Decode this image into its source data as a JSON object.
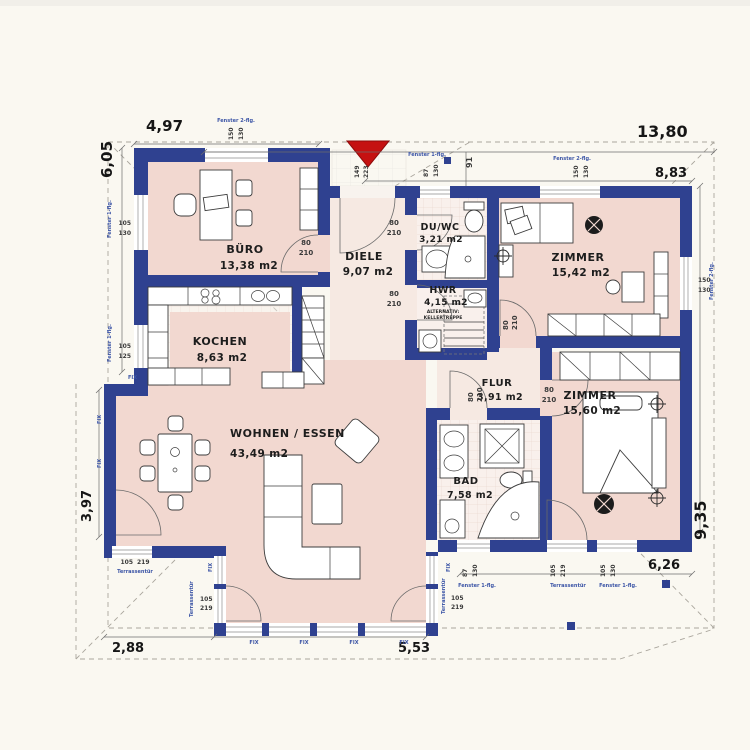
{
  "plan_title": "Erdgeschoss Grundriss",
  "colors": {
    "wall": "#2f4190",
    "room_pink": "#f2d8d0",
    "hall_pale": "#f6e9e2",
    "tile": "#f9f0ec",
    "background": "#faf8f1",
    "entrance_red": "#c51111",
    "label_blue": "#3c55a6"
  },
  "rooms": [
    {
      "id": "buero",
      "name": "BÜRO",
      "area": "13,38 m2"
    },
    {
      "id": "kochen",
      "name": "KOCHEN",
      "area": "8,63 m2"
    },
    {
      "id": "wohnen",
      "name": "WOHNEN / ESSEN",
      "area": "43,49 m2"
    },
    {
      "id": "diele",
      "name": "DIELE",
      "area": "9,07 m2"
    },
    {
      "id": "duwc",
      "name": "DU/WC",
      "area": "3,21 m2"
    },
    {
      "id": "hwr",
      "name": "HWR",
      "area": "4,15 m2",
      "note1": "ALTERNATIV:",
      "note2": "KELLERTREPPE"
    },
    {
      "id": "zimmer1",
      "name": "ZIMMER",
      "area": "15,42 m2"
    },
    {
      "id": "flur",
      "name": "FLUR",
      "area": "3,91 m2"
    },
    {
      "id": "bad",
      "name": "BAD",
      "area": "7,58 m2"
    },
    {
      "id": "zimmer2",
      "name": "ZIMMER",
      "area": "15,60 m2"
    }
  ],
  "dimensions": {
    "top_buero_width": "4,97",
    "left_buero_height": "6,05",
    "total_width": "13,80",
    "right_wing_width": "8,83",
    "entrance_offset": "91",
    "left_living_height": "3,97",
    "bottom_terrace_width": "2,88",
    "bottom_living_width": "5,53",
    "bottom_right_width": "6,26",
    "right_height": "9,35"
  },
  "entrance_door": {
    "w": "149",
    "h": "223"
  },
  "door_size": {
    "w": "80",
    "h": "210"
  },
  "window_types": {
    "one": "Fenster 1-flg.",
    "two": "Fenster 2-flg.",
    "terrace": "Terrassentür",
    "fix": "FIX"
  },
  "window_sizes": {
    "s150_130": [
      "150",
      "130"
    ],
    "s105_130": [
      "105",
      "130"
    ],
    "s105_125": [
      "105",
      "125"
    ],
    "s87_130": [
      "87",
      "130"
    ],
    "s105_219": [
      "105",
      "219"
    ]
  }
}
